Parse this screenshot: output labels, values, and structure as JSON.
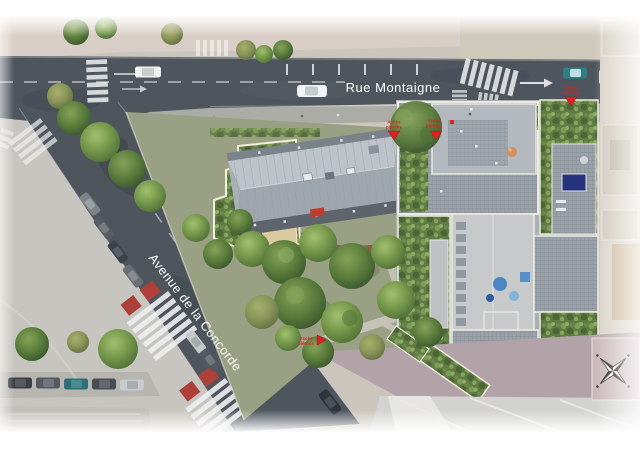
{
  "streets": {
    "rue_montaigne": "Rue Montaigne",
    "avenue_de_la_concorde": "Avenue de la Concorde"
  },
  "markers": [
    {
      "name": "acces-pietons-nord-ouest",
      "line1": "Accès",
      "line2": "piétons"
    },
    {
      "name": "acces-pietons-nord-est",
      "line1": "Accès",
      "line2": "piétons"
    },
    {
      "name": "acces-parking-rue-montaigne",
      "line1": "Accès",
      "line2": "parking"
    },
    {
      "name": "acces-pietons-sud",
      "line1": "Accès",
      "line2": "piétons"
    }
  ],
  "colors": {
    "road": "#4e555d",
    "label_white": "#ffffff",
    "marker_red": "#e02020",
    "crossing_red": "#ae4039",
    "vegetation": "#5f7c44",
    "building_roof": "#b0b6bc",
    "terrace_pavers": "#9aa1a8",
    "pool_blue": "#24337c",
    "promenade_mauve": "#b2a3a9",
    "site_outline_cream": "#f2eddc"
  }
}
